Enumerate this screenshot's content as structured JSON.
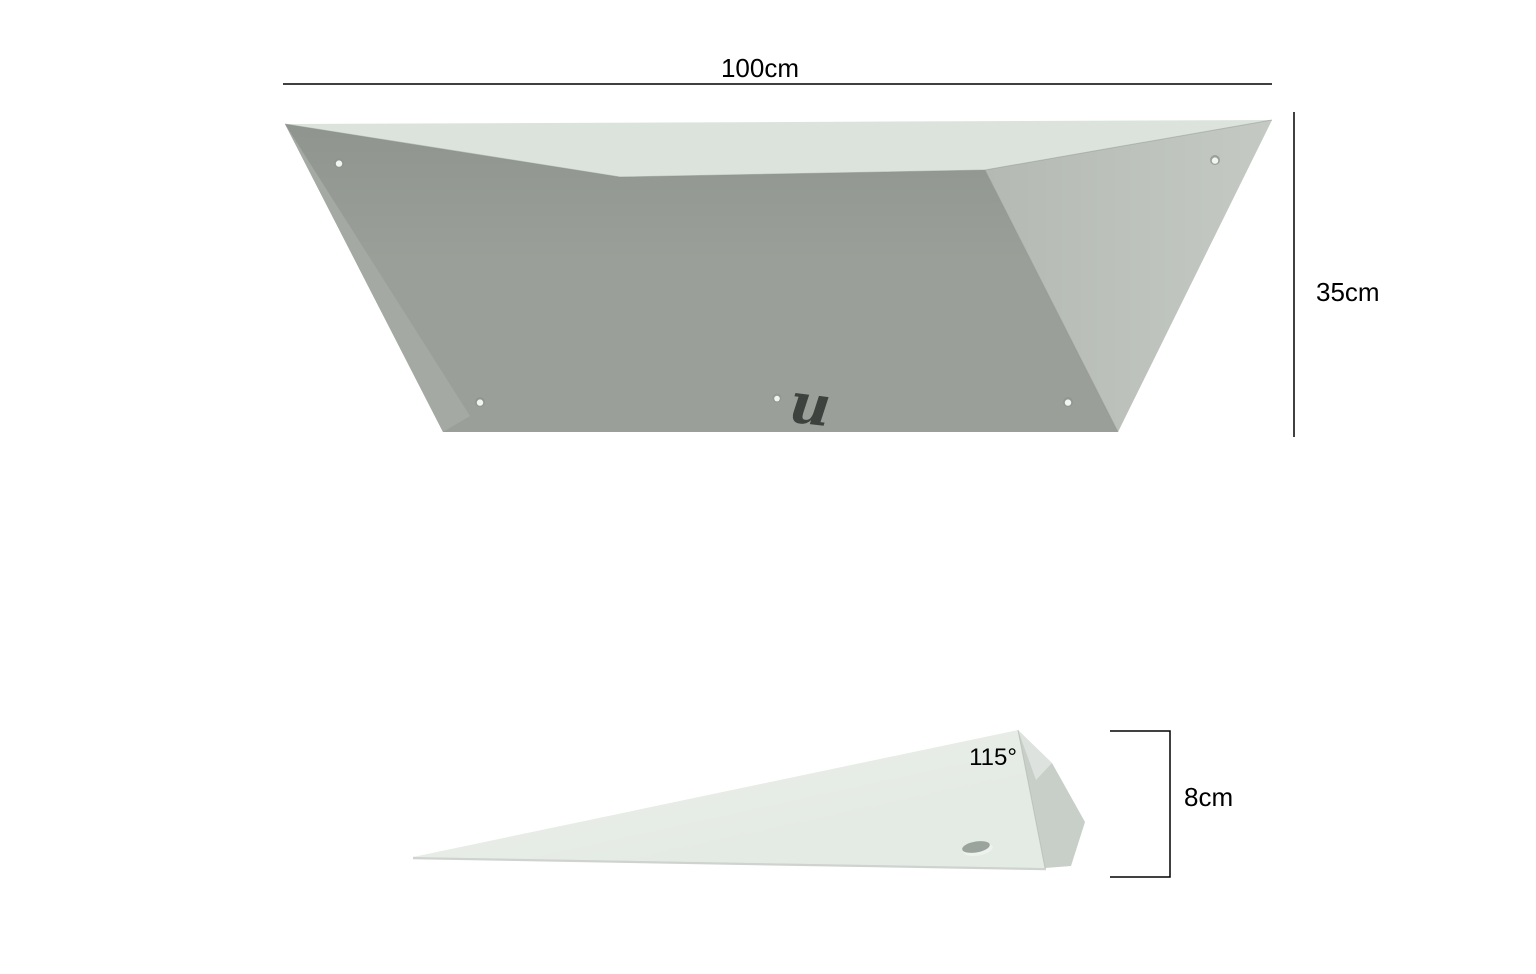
{
  "colors": {
    "background": "#ffffff",
    "dimension": "#000000",
    "top_face": "#dce3dc",
    "front_face": "#9aa099",
    "left_face": "#a4aaa3",
    "right_face": "#b4bab3",
    "side_main_face": "#e4eae4",
    "side_bevel_face": "#c7cfc8",
    "hole_light": "#f2f4f2",
    "hole_ring": "#8d938d",
    "hole_dark": "#9aa49c",
    "hole_rim": "#eef2ee",
    "logo": "#3e423e"
  },
  "front_view": {
    "width_label": "100cm",
    "height_label": "35cm",
    "logo_glyph": "u"
  },
  "side_view": {
    "angle_label": "115°",
    "height_label": "8cm"
  }
}
